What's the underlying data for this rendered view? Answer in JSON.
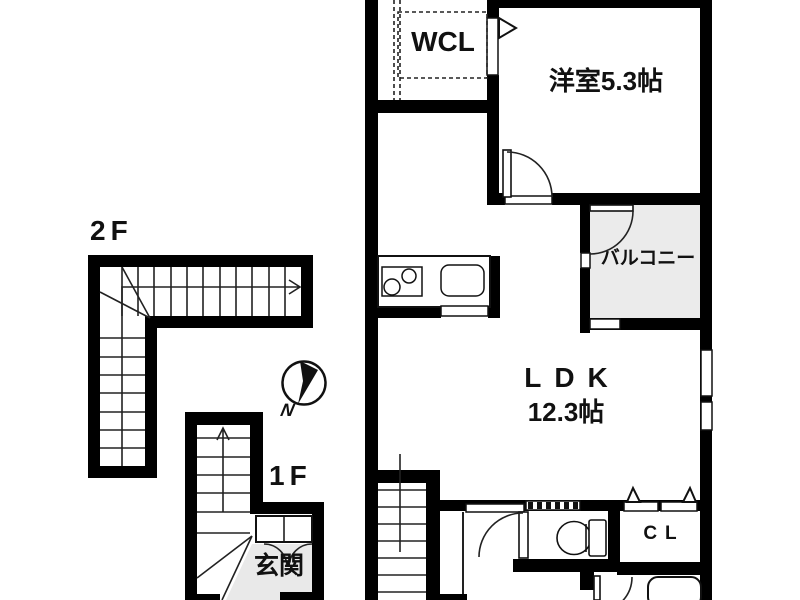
{
  "floor_plan": {
    "floor_labels": {
      "second": "2F",
      "first": "1F"
    },
    "rooms": {
      "walk_in_closet": "WCL",
      "western_room": "洋室5.3帖",
      "balcony": "バルコニー",
      "ldk": "LDK",
      "ldk_size": "12.3帖",
      "closet": "CL",
      "entrance": "玄関"
    },
    "compass": {
      "north": "N"
    },
    "colors": {
      "wall": "#000000",
      "balcony_floor": "#ebebeb",
      "entrance_floor": "#e9e9e9",
      "background": "#ffffff"
    }
  }
}
